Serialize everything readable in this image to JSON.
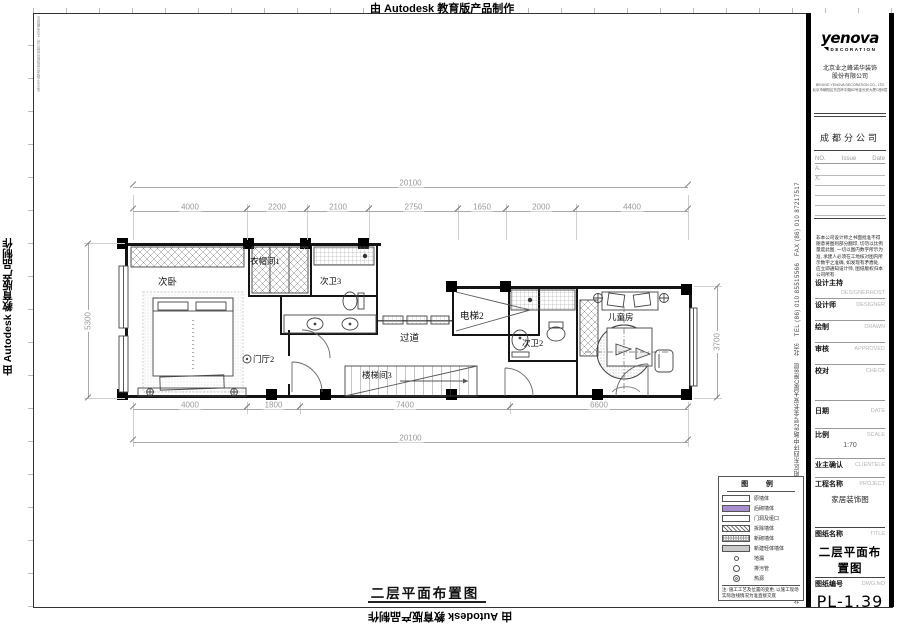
{
  "watermark": {
    "text": "由 Autodesk 教育版产品制作"
  },
  "frame": {
    "side_company": "北京业之峰诺华装饰股份有限公司, 北京市朝阳区东四环中路82号金长安大厦C座8层　北京　TEL (86) 010 85515566　FAX (86) 010 87217517"
  },
  "plan": {
    "title": "二层平面布置图",
    "rooms": {
      "bedroom2": "次卧",
      "cloakroom1": "衣帽间1",
      "bath3": "次卫3",
      "foyer2": "门厅2",
      "corridor": "过道",
      "stair3": "楼梯间3",
      "elevator2": "电梯2",
      "bath2": "次卫2",
      "kidsroom": "儿童房"
    },
    "dims": {
      "overall": "20100",
      "top": [
        "4000",
        "2200",
        "2100",
        "2750",
        "1650",
        "2000",
        "4400"
      ],
      "bottom": [
        "4000",
        "1800",
        "7400",
        "6600"
      ],
      "left": "5300",
      "right": "3700"
    }
  },
  "legend": {
    "title": "图 例",
    "items": [
      {
        "label": "原墙体"
      },
      {
        "label": "后砌墙体"
      },
      {
        "label": "门洞及垭口"
      },
      {
        "label": "拆除墙体"
      },
      {
        "label": "新砌墙体"
      },
      {
        "label": "新建轻体墙体"
      },
      {
        "label": "地漏"
      },
      {
        "label": "排污管"
      },
      {
        "label": "热源"
      }
    ],
    "note": "注: 施工工艺及位置的变更, 以施工现场实际放线情况为准直接交底"
  },
  "titleblock": {
    "logo": {
      "brand": "yenova",
      "sub": "DECORATION"
    },
    "company_cn": "北京业之峰诺华装饰",
    "company_cn2": "股份有限公司",
    "company_en": "BEIJING YENOVA DECORATION CO., LTD",
    "company_addr": "北京市朝阳区东四环中路82号金长安大厦C座8层",
    "branch": "成都分公司",
    "revisions": {
      "no": "NO.",
      "issue": "Issue",
      "date": "Date",
      "rows": [
        "A.",
        "X."
      ]
    },
    "disclaimer": "非本公司设计师之书面批准不得随意将图则部分翻印, 切勿以比例量度此图, 一切以图内数字所示为准, 承建人必须在工地核对图内所示数字之准确, 如发现有矛盾处, 应立即通知设计师, 图纸版权归本公司所有.",
    "fields": [
      {
        "label": "设计主持",
        "en": "DESIGNERHOST",
        "value": ""
      },
      {
        "label": "设计师",
        "en": "DESIGNER",
        "value": ""
      },
      {
        "label": "绘制",
        "en": "DRAWN",
        "value": ""
      },
      {
        "label": "审核",
        "en": "APPROVED",
        "value": ""
      },
      {
        "label": "校对",
        "en": "CHECK",
        "value": ""
      },
      {
        "label": "日期",
        "en": "DATE",
        "value": ""
      },
      {
        "label": "比例",
        "en": "SCALE",
        "value": "1:70"
      },
      {
        "label": "业主确认",
        "en": "CLIENTELE",
        "value": ""
      },
      {
        "label": "工程名称",
        "en": "PROJECT",
        "value": "家居装饰图"
      },
      {
        "label": "图纸名称",
        "en": "TITLE",
        "value": "二层平面布置图"
      },
      {
        "label": "图纸编号",
        "en": "DWG.NO",
        "value": "PL-1.39"
      }
    ],
    "colors": {
      "legend_purple": "#a98fd0"
    }
  }
}
